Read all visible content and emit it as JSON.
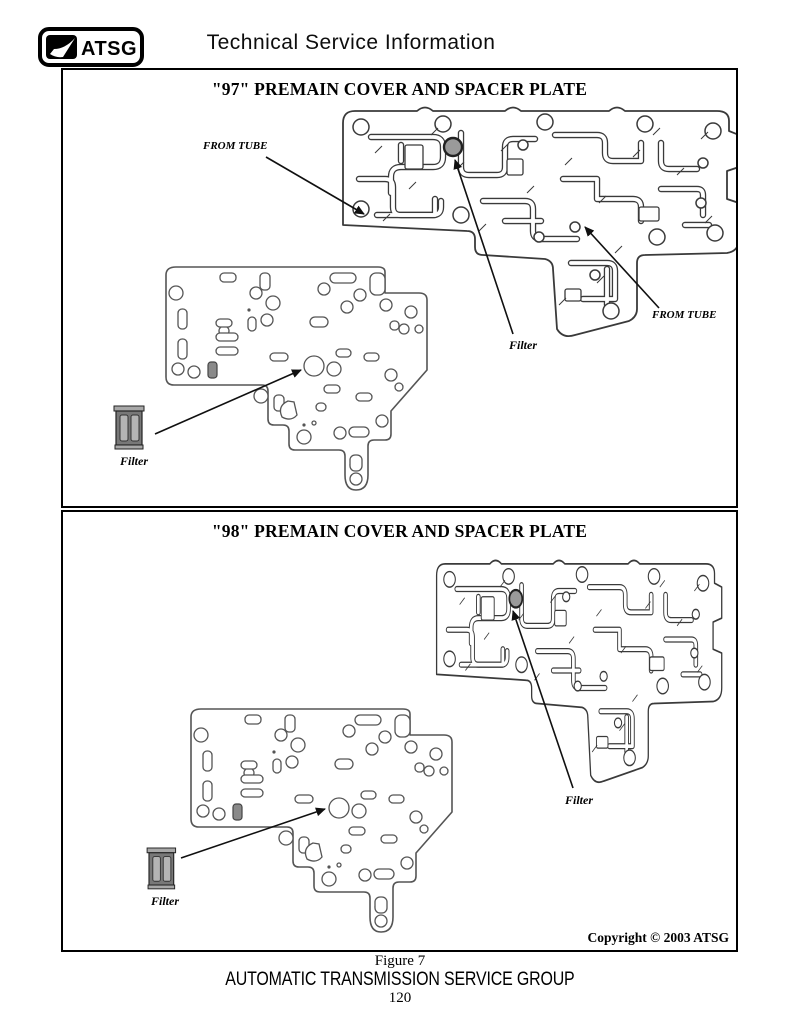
{
  "header": {
    "logo_text": "ATSG",
    "title": "Technical Service Information"
  },
  "panel_97": {
    "title": "\"97\" PREMAIN COVER AND SPACER PLATE",
    "from_tube_left": "FROM TUBE",
    "from_tube_right": "FROM TUBE",
    "filter_cover_label": "Filter",
    "filter_icon_label": "Filter"
  },
  "panel_98": {
    "title": "\"98\" PREMAIN COVER AND SPACER PLATE",
    "filter_cover_label": "Filter",
    "filter_icon_label": "Filter",
    "copyright": "Copyright © 2003 ATSG"
  },
  "footer": {
    "figure": "Figure 7",
    "org": "AUTOMATIC TRANSMISSION SERVICE GROUP",
    "page_number": "120"
  },
  "colors": {
    "line": "#3a3a3a",
    "plate_line": "#555555",
    "filter_dot": "#9a9a9a",
    "ink": "#000000"
  }
}
